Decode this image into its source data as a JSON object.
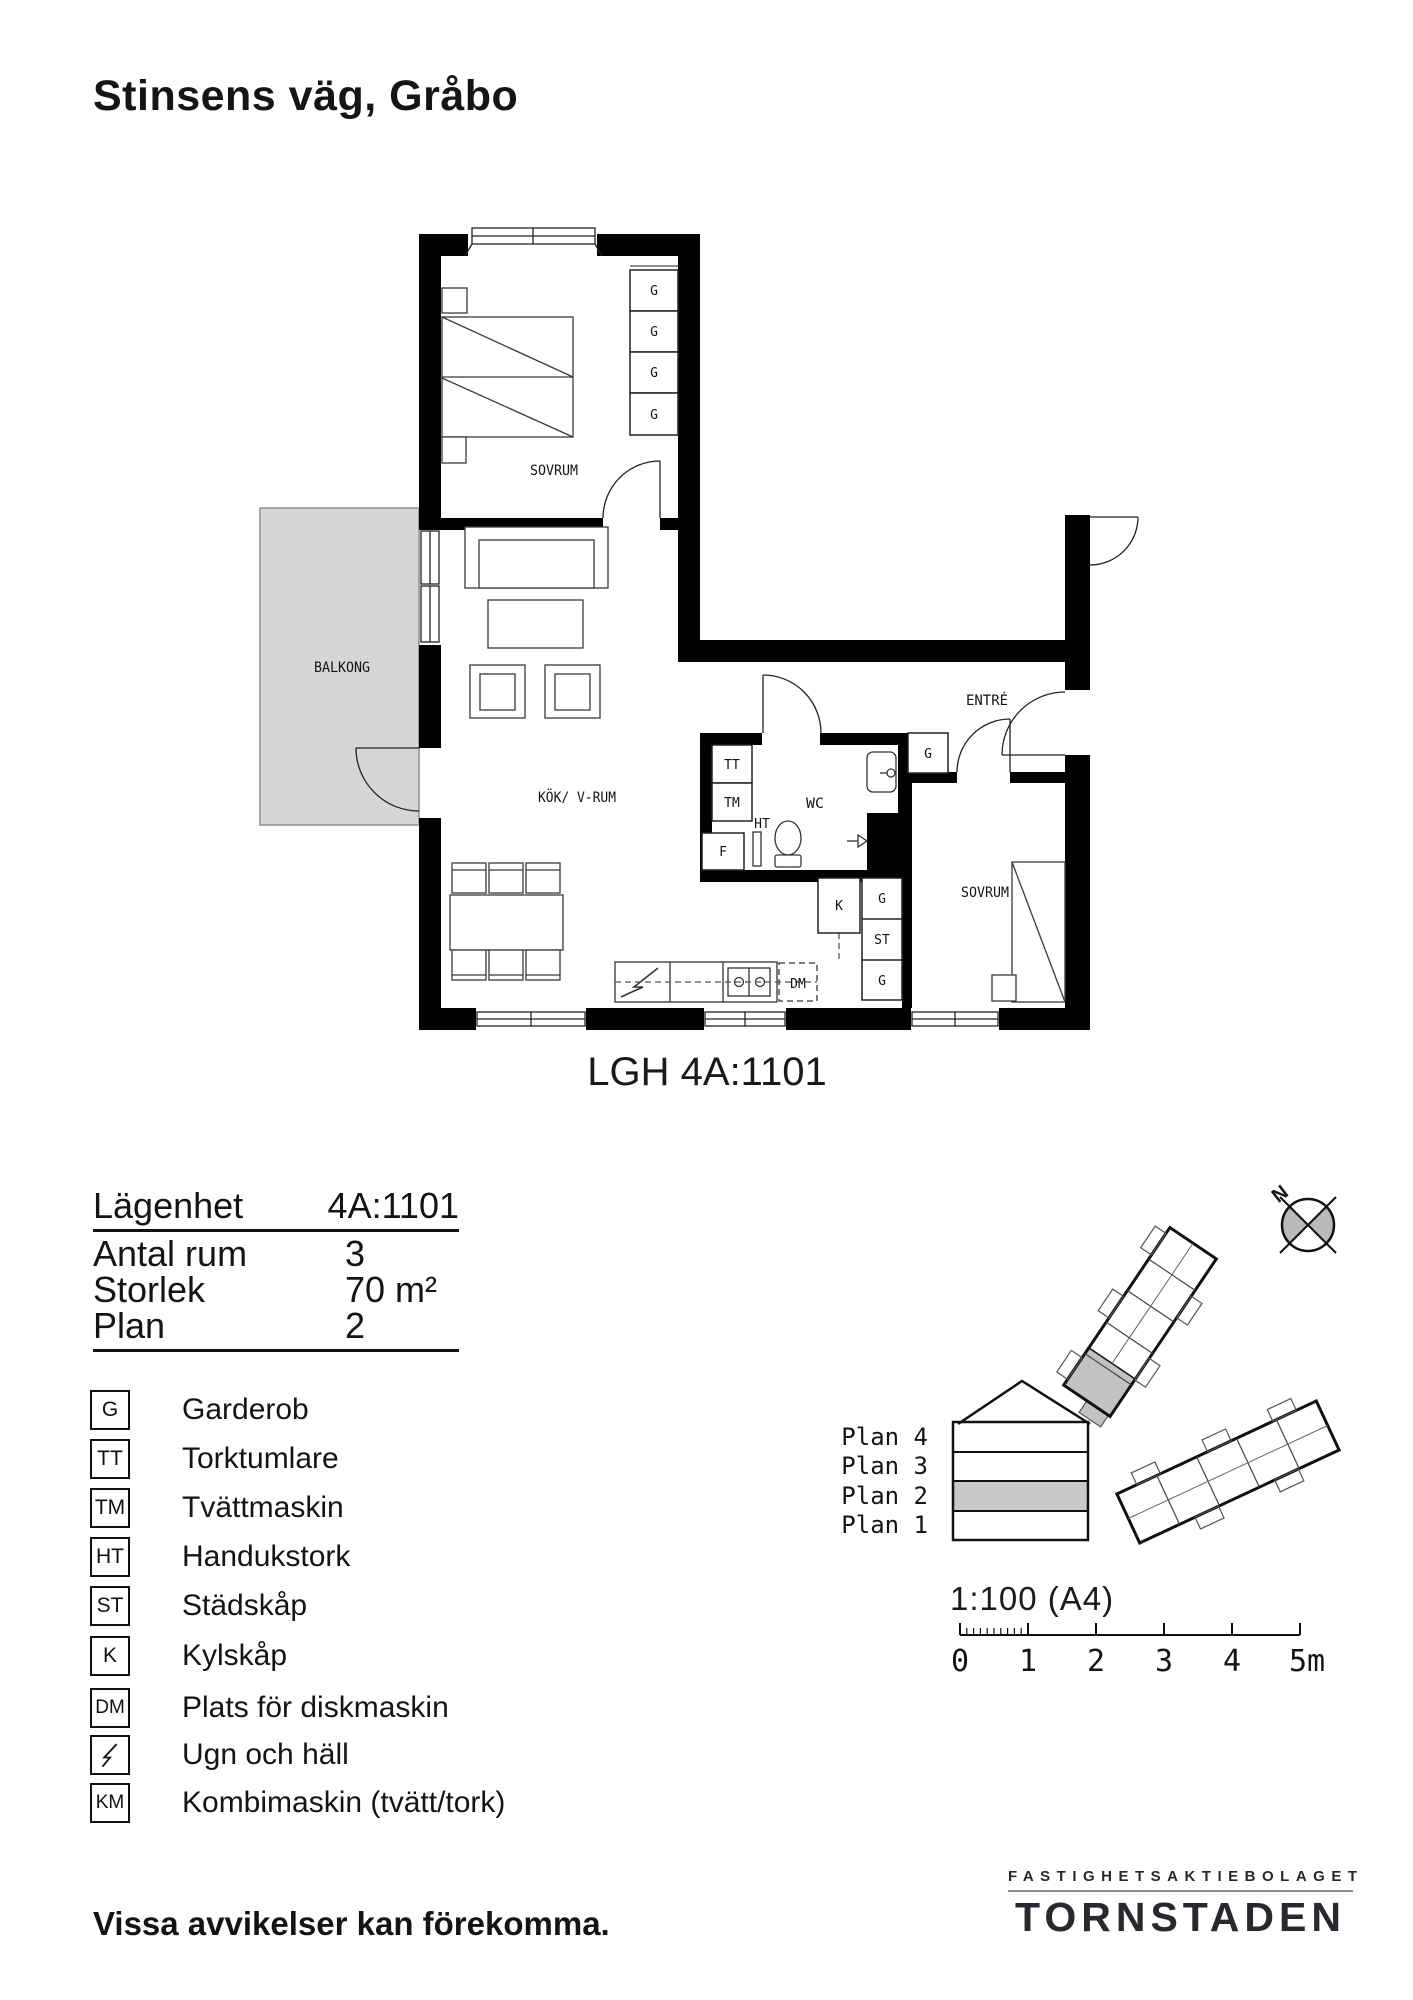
{
  "header": {
    "title": "Stinsens väg, Gråbo"
  },
  "plan": {
    "caption": "LGH 4A:1101",
    "rooms": {
      "bedroom1": "SOVRUM",
      "bedroom2": "SOVRUM",
      "balcony": "BALKONG",
      "kitchen": "KÖK/ V-RUM",
      "wc": "WC",
      "entry": "ENTRÉ"
    },
    "markers": {
      "g": "G",
      "tt": "TT",
      "tm": "TM",
      "ht": "HT",
      "f": "F",
      "k": "K",
      "st": "ST",
      "dm": "DM"
    }
  },
  "info": {
    "rows": [
      {
        "label": "Lägenhet",
        "value": "4A:1101"
      },
      {
        "label": "Antal rum",
        "value": "3"
      },
      {
        "label": "Storlek",
        "value": "70 m²"
      },
      {
        "label": "Plan",
        "value": "2"
      }
    ]
  },
  "legend": {
    "items": [
      {
        "code": "G",
        "label": "Garderob"
      },
      {
        "code": "TT",
        "label": "Torktumlare"
      },
      {
        "code": "TM",
        "label": "Tvättmaskin"
      },
      {
        "code": "HT",
        "label": "Handukstork"
      },
      {
        "code": "ST",
        "label": "Städskåp"
      },
      {
        "code": "K",
        "label": "Kylskåp"
      },
      {
        "code": "DM",
        "label": "Plats för diskmaskin"
      },
      {
        "code": "",
        "symbol": "lightning-bolt",
        "label": "Ugn och häll"
      },
      {
        "code": "KM",
        "label": "Kombimaskin (tvätt/tork)"
      }
    ]
  },
  "site": {
    "compass": "N"
  },
  "levels": {
    "items": [
      {
        "label": "Plan 4",
        "active": false
      },
      {
        "label": "Plan 3",
        "active": false
      },
      {
        "label": "Plan 2",
        "active": true
      },
      {
        "label": "Plan 1",
        "active": false
      }
    ]
  },
  "scale": {
    "ratio": "1:100 (A4)",
    "ticks": [
      "0",
      "1",
      "2",
      "3",
      "4",
      "5m"
    ]
  },
  "brand": {
    "over": "FASTIGHETSAKTIEBOLAGET",
    "name": "TORNSTADEN"
  },
  "footer": {
    "disclaimer": "Vissa avvikelser kan förekomma."
  },
  "colors": {
    "balcony": "#d6d6d6",
    "active_plan": "#c9c9c9",
    "site_unit": "#c2c2c2",
    "ink": "#111111"
  }
}
